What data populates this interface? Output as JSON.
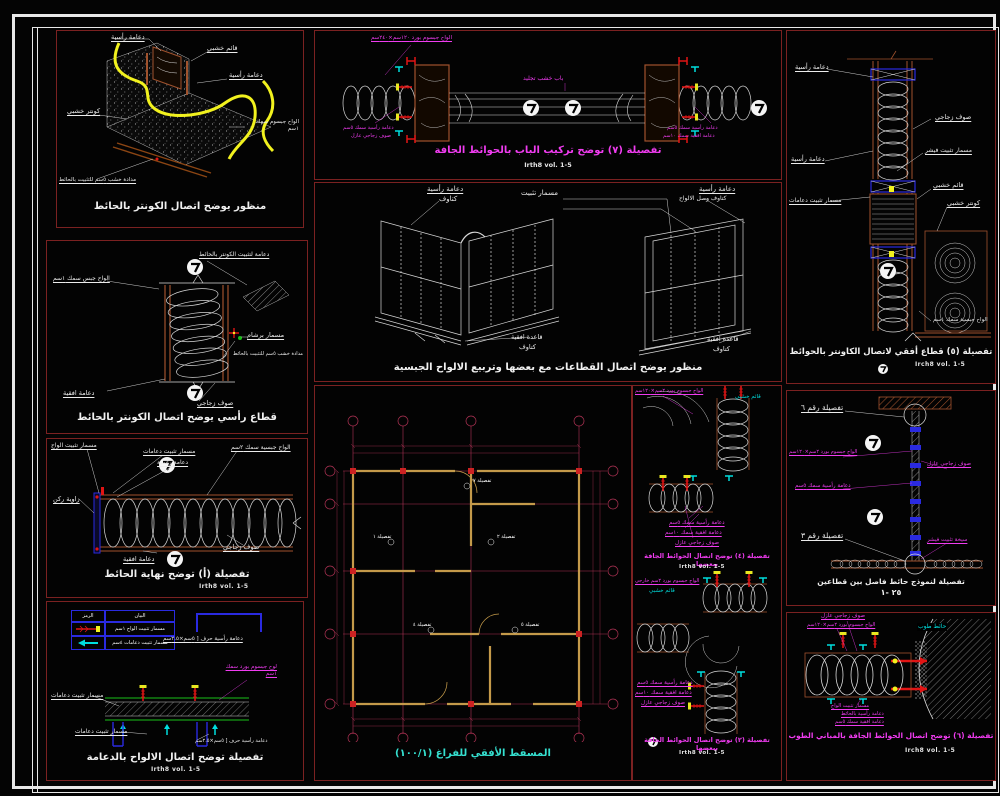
{
  "colors": {
    "background": "#040404",
    "panel_border": "#7b2121",
    "frame_white": "#e9e9e9",
    "line_white": "#d8d8d8",
    "wood_brown": "#a0522d",
    "highlight_yellow": "#f2f21e",
    "label_magenta": "#f03cf0",
    "label_cyan": "#00dede",
    "grid_crimson": "#b03355",
    "wall_tan": "#c49a4a",
    "accent_red": "#e11414",
    "accent_green": "#18c018",
    "accent_blue": "#2a2ae0",
    "caption_teal": "#35e0d0"
  },
  "panels": {
    "p1": {
      "caption": "منظور يوضح اتصال الكونتر بالحائط",
      "labels": {
        "vs1": "دعامة رأسية",
        "post": "قائم خشبي",
        "vs2": "دعامة رأسية",
        "counter": "كونتر خشبي",
        "boards": "الواح جبسوم سمك ١سم",
        "batten": "مدادة خشب ٥سم للتثبيت بالحائط"
      }
    },
    "p2": {
      "caption": "قطاع رأسي يوضح اتصال الكونتر بالحائط",
      "labels": {
        "fix": "دعامة لتثبيت الكونتر بالحائط",
        "boards": "الواح جبس سمك ١سم",
        "rivet": "مسمار برشام",
        "batten": "مدادة خشب ٥سم للتثبيت بالحائط",
        "horiz": "دعامة افقية",
        "wool": "صوف زجاجي"
      }
    },
    "p3": {
      "caption": "تفصيلة (أ) توضح نهاية الحائط",
      "ref": "Irth8 vol.  1-5",
      "labels": {
        "bnail": "مسمار تثبيت الواح",
        "snail": "مسمار تثبيت دعامات",
        "vs": "دعامة رأسية",
        "boards": "الواح جبسية سمك ٢سم",
        "corner": "زاوية ركن",
        "horiz": "دعامة افقية",
        "wool": "صوف زجاجي"
      }
    },
    "p4": {
      "caption": "تفصيلة توضح اتصال الالواح بالدعامة",
      "ref": "Irth8 vol.  1-5",
      "legend": {
        "desc": "البيان",
        "sym": "الرمز",
        "r1": "مسمار تثبيت الواح ١سم",
        "r2": "مسمار تثبيت دعامات ٤سم"
      },
      "labels": {
        "chan1": "دعامة رأسية حرف [ ٥سم×٢.٥سم",
        "board": "لوح جبسوم بورد سمك ١سم",
        "snail1": "مسمار تثبيت دعامات",
        "snail2": "مسمار تثبيت دعامات",
        "chan2": "دعامة رأسية حرف [ ٥سم×٢.٥سم"
      }
    },
    "p5": {
      "caption": "تفصيلة (٧) توضح تركيب الباب بالحوائط الجافة",
      "ref": "Irth8 vol.  1-5",
      "labels": {
        "boards": "الواح جبسوم بورد ١٢٠سم×٢٤٠سم",
        "door": "باب خشب تجليد",
        "vs_l": "دعامة رأسية سمك ٥سم",
        "wool_l": "صوف زجاجي عازل",
        "vs_r": "دعامة رأسية سمك ٥سم",
        "hs_r": "دعامة افقية سمك ١٠سم"
      }
    },
    "p6": {
      "caption": "منظور يوضح اتصال القطاعات مع بعضها وتربيع الالواح الجبسية",
      "labels": {
        "vs_l": "دعامة رأسية",
        "kat_l": "كتاوف",
        "nail": "مسمار تثبيت",
        "vs_r": "دعامة رأسية",
        "kat_r": "كتاوف وصل الالواح",
        "base_l": "قاعدة افقية",
        "kat_bl": "كتاوف",
        "base_r": "قاعدة افقية",
        "kat_br": "كتاوف"
      }
    },
    "p7": {
      "caption": "المسقط الأفقي للفراغ  (١٠٠/١)",
      "callouts": [
        "تفصيلة ٧",
        "تفصيلة ١",
        "تفصيلة ٢",
        "تفصيلة ٤",
        "تفصيلة ٥"
      ]
    },
    "p8": {
      "d4": {
        "caption": "تفصيلة (٤) توضح اتصال الحوائط الجافة ببعضها",
        "ref": "Irth8 vol.  1-5",
        "labels": {
          "boards": "الواح جبسوم بورد ٢سم×١٢٠سم",
          "post": "قائم خشبي",
          "vs": "دعامة رأسية سمك ٥سم",
          "hs": "دعامة افقية سمك ١٠سم",
          "wool": "صوف زجاجي عازل"
        }
      },
      "d2": {
        "caption": "تفصيلة (٢) توضح اتصال الحوائط الجافة ببعضها",
        "ref": "Irth8 vol.  1-5",
        "labels": {
          "boards": "الواح جبسوم بورد ٢سم خارجي",
          "post": "قائم خشبي",
          "vs": "دعامة رأسية سمك ٥سم",
          "hs": "دعامة افقية سمك ١٠سم",
          "wool": "صوف زجاجي عازل"
        }
      }
    },
    "p9": {
      "caption": "تفصيلة (٥) قطاع أفقي لاتصال الكاونتر بالحوائط",
      "ref": "Irch8 vol.  1-5",
      "labels": {
        "vs1": "دعامة رأسية",
        "wool": "صوف زجاجي",
        "vs2": "دعامة رأسية",
        "fischer": "مسمار تثبيت فيشر",
        "snail": "مسمار تثبيت دعامات",
        "post": "قائم خشبي",
        "counter": "كونتر خشبي",
        "boards": "الواح جبسية سمك ١سم"
      }
    },
    "p10": {
      "caption": "تفصيلة لنموذج حائط فاصل بين قطاعين",
      "scale": "٢٥ -١",
      "labels": {
        "d6": "تفصيلة رقم ٦",
        "boards": "الواح جبسوم بورد ٢سم×١٢٠سم",
        "wool": "صوف زجاجي عازل",
        "vs": "دعامة رأسية سمك ٥سم",
        "d3": "تفصيلة رقم ٣",
        "fischer": "سيخة تثبيت فيشر"
      }
    },
    "p11": {
      "caption": "تفصيلة (٦) توضح اتصال الحوائط الجافة بالمباني الطوب",
      "ref": "Irch8 vol.  1-5",
      "labels": {
        "wool": "صوف زجاجي عازل",
        "boards": "الواح جبسوم بورد ٢سم×١٢٠سم",
        "brick": "حائط طوب",
        "bnail": "مسمار تثبيت الواح",
        "vs": "دعامة رأسية بالحائط",
        "hs": "دعامة افقية سمك ٥سم"
      }
    }
  }
}
